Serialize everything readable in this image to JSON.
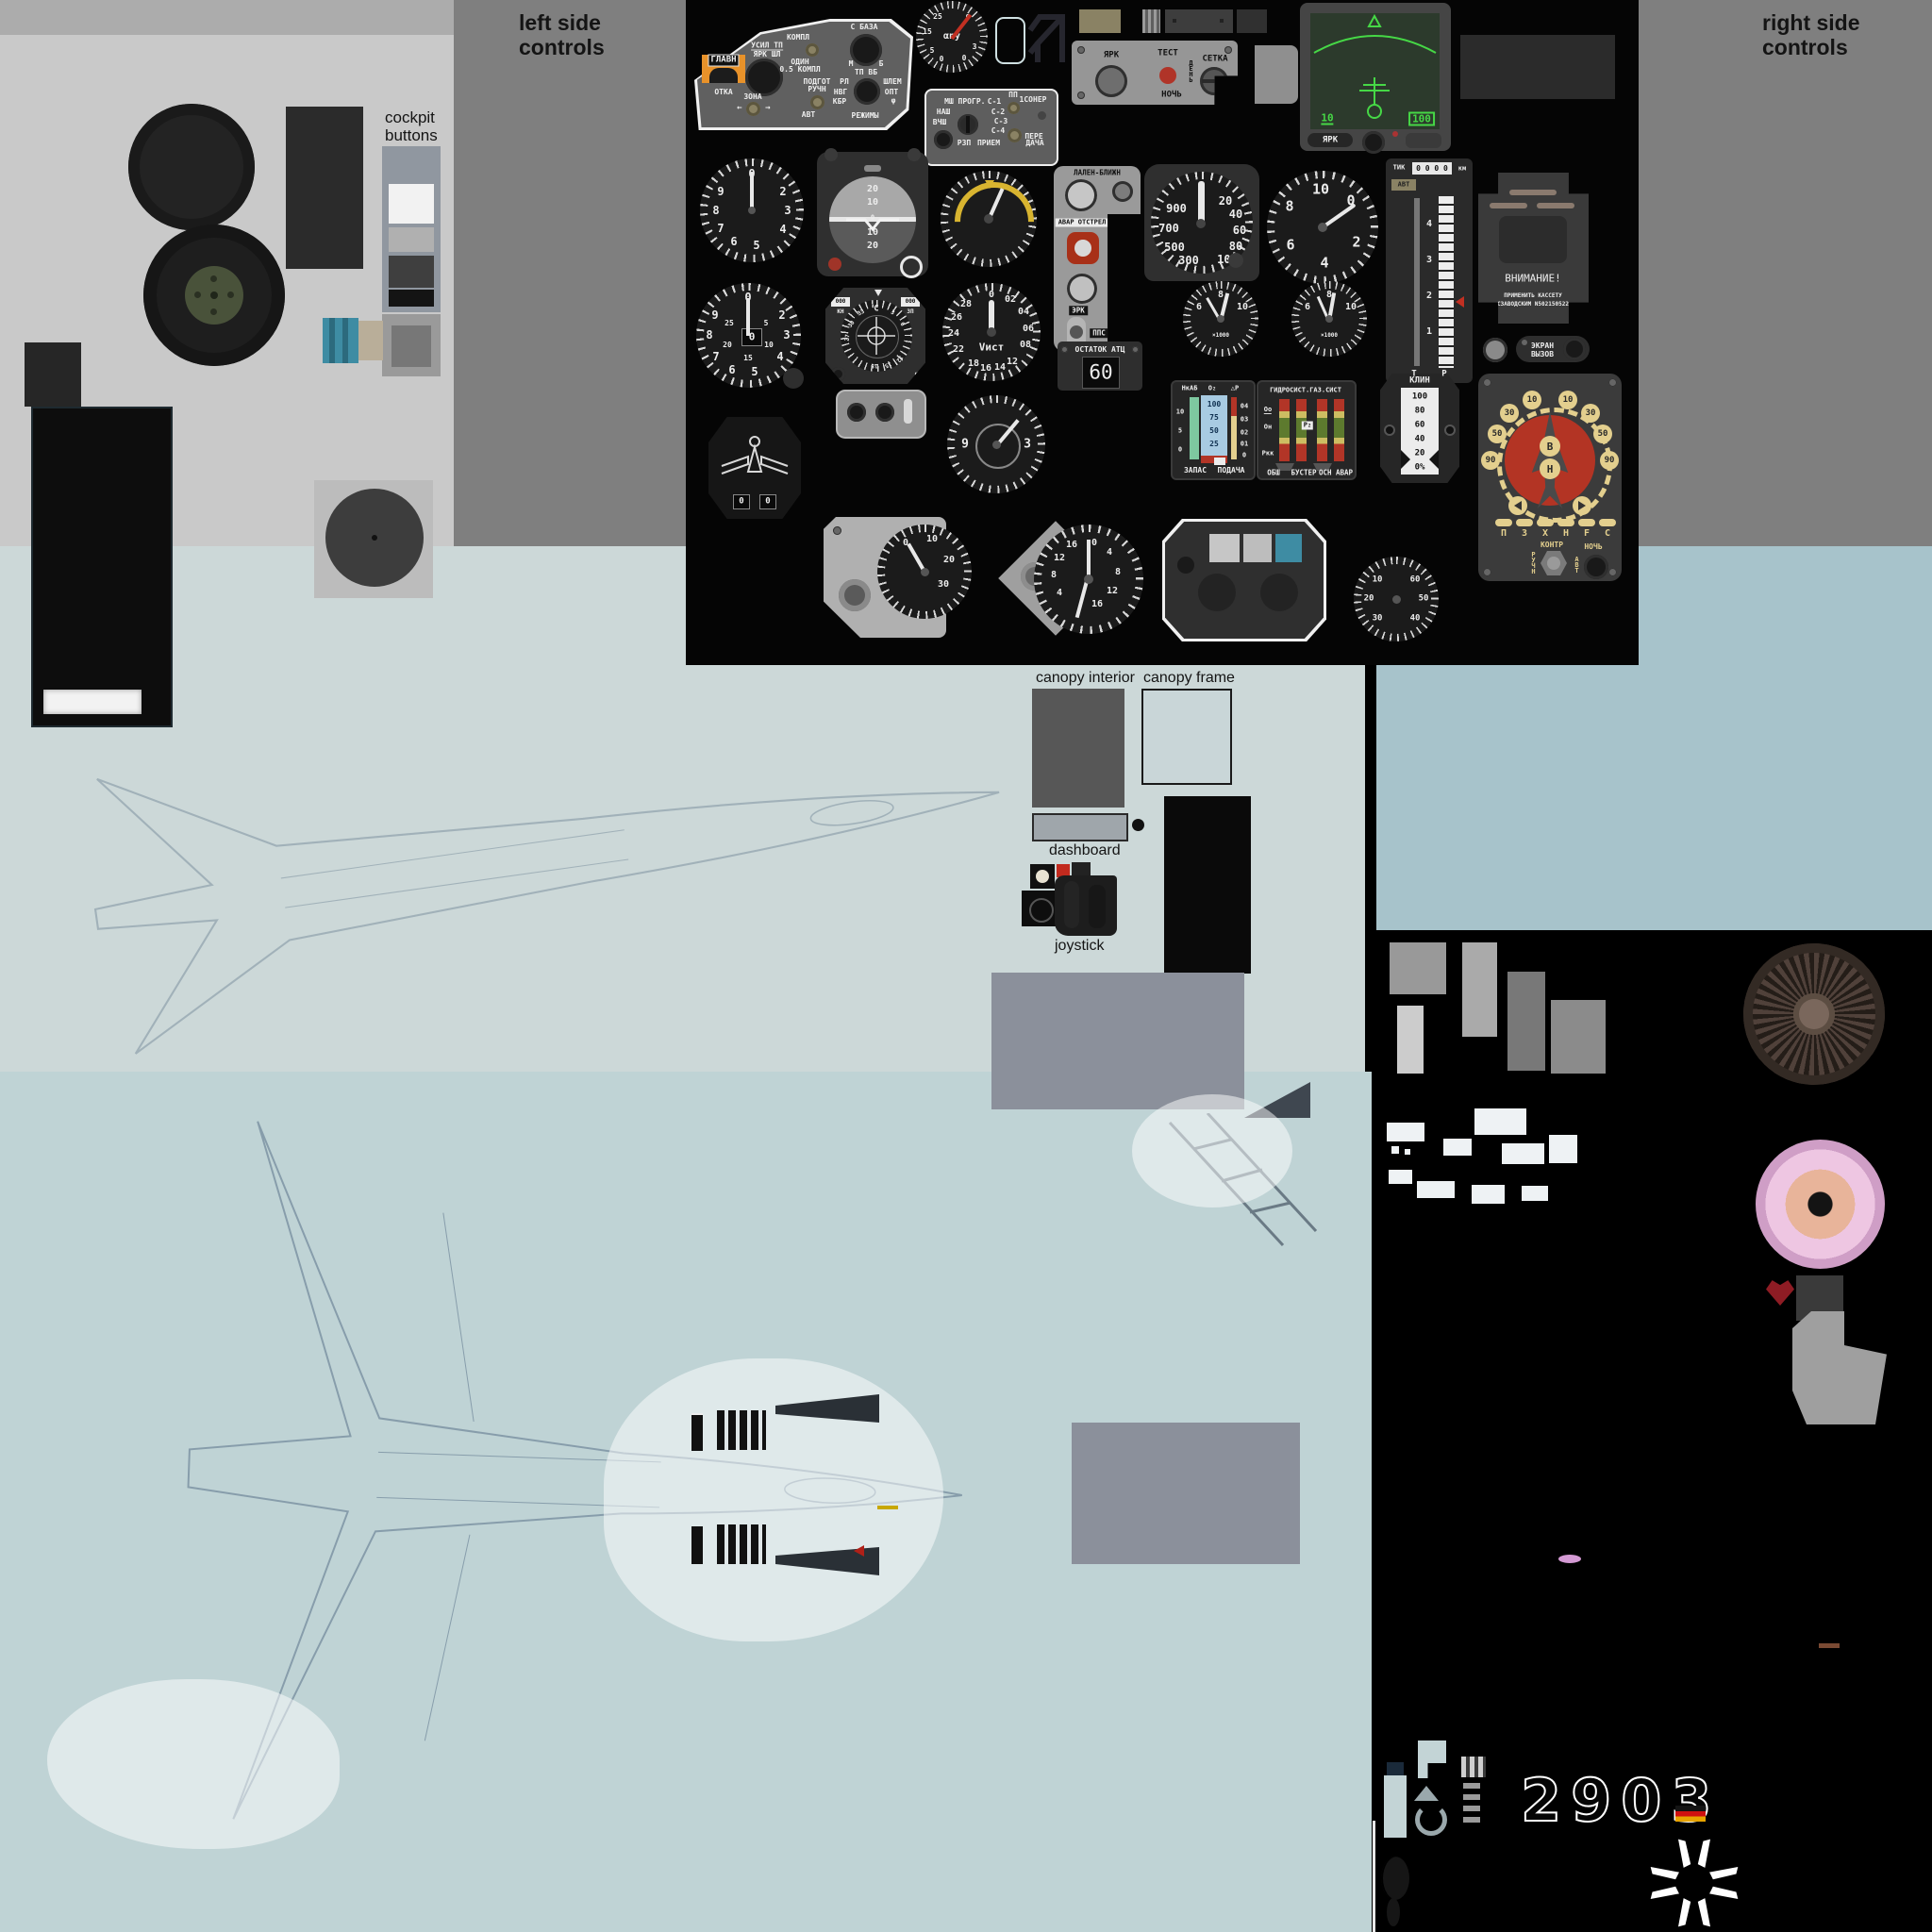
{
  "colors": {
    "bg_black": "#050505",
    "gray_light": "#c9c9c9",
    "gray_mid": "#7f7f7f",
    "gray_topstrip": "#acacac",
    "blue_upper": "#ccd8d8",
    "blue_lower": "#bfd3d5",
    "blue_right": "#a7c3cb",
    "panel_gray": "#6e6e6e",
    "instrument_black": "#1b1b1b",
    "bezel_gray": "#3c3c3c",
    "accent_orange": "#e8922a",
    "radar_green": "#46d846",
    "radar_screen": "#2c3a2c",
    "teal": "#3e8ca3",
    "red": "#b63222",
    "cream": "#e3cf8e",
    "pink": "#e0b0d6",
    "turbine_brown": "#4c3e35",
    "olive": "#8a8264",
    "flag_red": "#cf1010",
    "flag_gold": "#e7a400"
  },
  "annotations": {
    "left_side_1": "left side",
    "left_side_2": "controls",
    "right_side_1": "right side",
    "right_side_2": "controls",
    "cockpit_buttons_1": "cockpit",
    "cockpit_buttons_2": "buttons",
    "canopy_interior": "canopy interior",
    "canopy_frame": "canopy frame",
    "dashboard": "dashboard",
    "joystick": "joystick"
  },
  "left_panel": {
    "glavn": "ГЛАВН",
    "otka": "ОТКА",
    "usil_tp": "УСИЛ ТП",
    "yark_shl": "ЯРК ШЛ",
    "zona": "ЗОНА",
    "arrow_left": "←",
    "arrow_right": "→",
    "kompl": "КОМПЛ",
    "odin": "ОДИН",
    "half_kompl": "0.5 КОМПЛ",
    "podgot": "ПОДГОТ",
    "ruchn": "РУЧН",
    "avt": "АВТ",
    "s_baza": "С БАЗА",
    "m": "М",
    "b": "Б",
    "tp_vb": "ТП ВБ",
    "rl": "РЛ",
    "nvg": "НВГ",
    "kbr": "КБР",
    "shlem": "ШЛЕМ",
    "opt": "ОПТ",
    "phi": "φ",
    "rezhimy": "РЕЖИМЫ"
  },
  "radio_panel": {
    "msh": "МШ",
    "progr": "ПРОГР.",
    "c1": "С-1",
    "c2": "С-2",
    "c3": "С-3",
    "c4": "С-4",
    "nash": "НАШ",
    "vchsh": "ВЧШ",
    "rzp": "РЗП",
    "priem": "ПРИЕМ",
    "pp": "ПП",
    "soner": "1СОНЕР",
    "pere": "ПЕРЕ",
    "dacha": "ДАЧА"
  },
  "brightness_panel": {
    "yark": "ЯРК",
    "test": "ТЕСТ",
    "den": "ДЕНЬ",
    "setka": "СЕТКА",
    "noch": "НОЧЬ"
  },
  "radar": {
    "scale_low": "10",
    "scale_high": "100",
    "yark": "ЯРК"
  },
  "aoa": {
    "label": "αnу",
    "left": [
      "25",
      "15",
      "5",
      "0"
    ],
    "right": [
      "9",
      "3",
      "0"
    ]
  },
  "clock": {
    "numbers": [
      "0",
      "2",
      "3",
      "4",
      "5",
      "6",
      "7",
      "8",
      "9"
    ]
  },
  "attitude": {
    "pitch": [
      "20",
      "10",
      "10",
      "20"
    ],
    "zero": "0"
  },
  "side_panel": {
    "title": "ЛАЛЕН-БЛИЖН",
    "avar": "АВАР",
    "otstrel": "ОТСТРЕЛ",
    "erk": "ЭРК",
    "pps": "ППС",
    "eps": "ЭПС"
  },
  "fuel": {
    "label": "ОСТАТОК АТЦ",
    "value": "60"
  },
  "speed": {
    "left": [
      "900",
      "700",
      "500",
      "300"
    ],
    "right": [
      "20",
      "40",
      "60",
      "80",
      "100"
    ]
  },
  "altimeter": {
    "numbers": [
      "10",
      "0",
      "2",
      "4",
      "6",
      "8"
    ]
  },
  "range_tape": {
    "top": "ТИК",
    "window": "0 0 0 0",
    "km": "км",
    "avt": "АВТ",
    "scale": [
      "4",
      "3",
      "2",
      "1"
    ],
    "t": "Т",
    "r": "Р"
  },
  "warning": {
    "title": "ВНИМАНИЕ!",
    "line1": "ПРИМЕНИТЬ КАССЕТУ",
    "line2": "СЗАВОДСКИМ N502150522",
    "ekran": "ЭКРАН",
    "vyzov": "ВЫЗОВ"
  },
  "stopwatch": {
    "outer": [
      "0",
      "2",
      "3",
      "4",
      "5",
      "6",
      "7",
      "8",
      "9"
    ],
    "inner": [
      "5",
      "10",
      "15",
      "20",
      "25"
    ],
    "window": "0"
  },
  "adf": {
    "north": "С",
    "win_left": "000",
    "win_right": "000",
    "kn": "КН",
    "zp": "ЗП",
    "phi": "φ",
    "card": [
      "33",
      "30",
      "27",
      "3",
      "6",
      "12",
      "15",
      "18"
    ]
  },
  "vist": {
    "label": "Vист",
    "numbers": [
      "0",
      "02",
      "04",
      "06",
      "08",
      "12",
      "14",
      "16",
      "18",
      "22",
      "24",
      "26",
      "28"
    ]
  },
  "rpm": {
    "numbers": [
      "6",
      "8",
      "10"
    ],
    "x1000": "×1000"
  },
  "oxygen": {
    "title_l": "НкАБ",
    "title_o2": "О₂",
    "title_dp": "△Р",
    "left": [
      "10",
      "5",
      "0"
    ],
    "column": [
      "100",
      "75",
      "50",
      "25"
    ],
    "right": [
      "04",
      "03",
      "02",
      "01",
      "0"
    ],
    "zapas": "ЗАПАС",
    "podacha": "ПОДАЧА"
  },
  "hydraulic": {
    "title": "ГИДРОСИСТ.ГАЗ.СИСТ",
    "o0": "Оо",
    "on": "Он",
    "rkk": "Ркк",
    "p2": "Р₂",
    "obsh": "ОБШ",
    "buster": "БУСТЕР",
    "osn_avar": "ОСН АВАР"
  },
  "klin": {
    "title": "КЛИН",
    "values": [
      "100",
      "80",
      "60",
      "40",
      "20",
      "0%"
    ]
  },
  "pos_ind": {
    "ring": [
      "10",
      "10",
      "30",
      "30",
      "50",
      "50",
      "90",
      "90"
    ],
    "v": "В",
    "n": "Н",
    "lamps": [
      "П",
      "З",
      "Х",
      "Н",
      "F",
      "С"
    ],
    "kontr": "КОНТР",
    "ruchn": "РУЧН",
    "noch": "НОЧЬ",
    "avt": "АВТ"
  },
  "wing_emblem": {
    "w1": "0",
    "w2": "0"
  },
  "chrono": {
    "n9": "9",
    "n3": "3"
  },
  "bracket_gauge": {
    "numbers": [
      "0",
      "10",
      "20",
      "30"
    ]
  },
  "diamond_gauge": {
    "left": [
      "16",
      "12",
      "8",
      "4"
    ],
    "right": [
      "0",
      "4",
      "8",
      "12",
      "16"
    ]
  },
  "pressure_gauge": {
    "numbers": [
      "10",
      "20",
      "30",
      "40",
      "50",
      "60"
    ]
  },
  "markings": {
    "tail_number": "2903"
  }
}
